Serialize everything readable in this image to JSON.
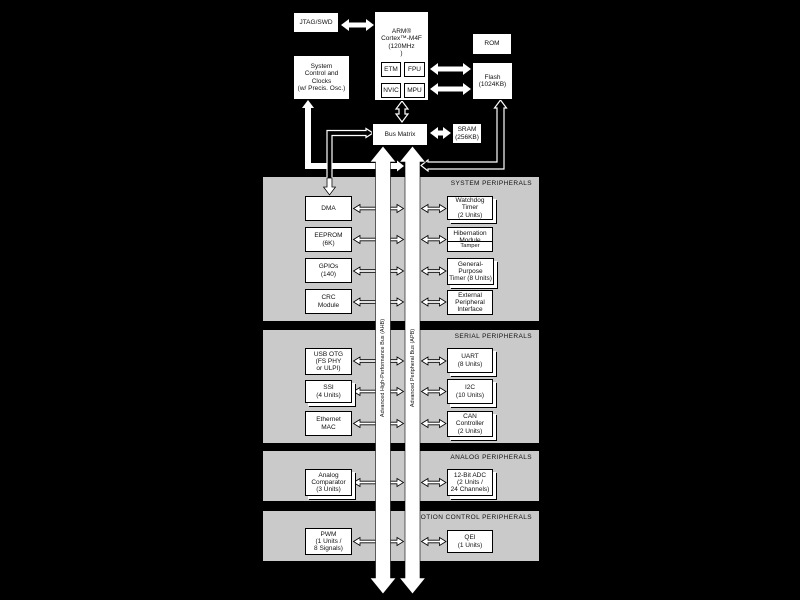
{
  "top": {
    "jtag": "JTAG/SWD",
    "system_control": "System\nControl and\nClocks\n(w/ Precis. Osc.)",
    "cpu": "ARM®\nCortex™-M4F\n(120MHz\n)",
    "cpu_units": {
      "etm": "ETM",
      "fpu": "FPU",
      "nvic": "NVIC",
      "mpu": "MPU"
    },
    "rom": "ROM",
    "flash": "Flash\n(1024KB)",
    "bus_matrix": "Bus Matrix",
    "sram": "SRAM\n(256KB)"
  },
  "buses": {
    "ahb": "Advanced High-Performance Bus (AHB)",
    "apb": "Advanced Peripheral Bus (APB)"
  },
  "sections": {
    "system": {
      "title": "SYSTEM PERIPHERALS",
      "boxes": {
        "dma": "DMA",
        "eeprom": "EEPROM\n(6K)",
        "gpios": "GPIOs\n(140)",
        "crc": "CRC\nModule",
        "watchdog": "Watchdog\nTimer\n(2 Units)",
        "hibernation": "Hibernation\nModule",
        "tamper": "Tamper",
        "gptimer": "General-\nPurpose\nTimer (8 Units)",
        "epi": "External\nPeripheral\nInterface"
      }
    },
    "serial": {
      "title": "SERIAL PERIPHERALS",
      "boxes": {
        "usb": "USB OTG\n(FS PHY\nor ULPI)",
        "ssi": "SSI\n(4 Units)",
        "ethernet": "Ethernet\nMAC",
        "uart": "UART\n(8 Units)",
        "i2c": "I2C\n(10 Units)",
        "can": "CAN\nController\n(2 Units)"
      }
    },
    "analog": {
      "title": "ANALOG PERIPHERALS",
      "boxes": {
        "comparator": "Analog\nComparator\n(3 Units)",
        "adc": "12-Bit ADC\n(2 Units /\n24 Channels)"
      }
    },
    "motion": {
      "title": "MOTION CONTROL PERIPHERALS",
      "boxes": {
        "pwm": "PWM\n(1 Units /\n8 Signals)",
        "qei": "QEI\n(1 Units)"
      }
    }
  },
  "colors": {
    "background": "#000000",
    "section_fill": "#cacaca",
    "box_fill": "#ffffff",
    "line": "#000000"
  }
}
